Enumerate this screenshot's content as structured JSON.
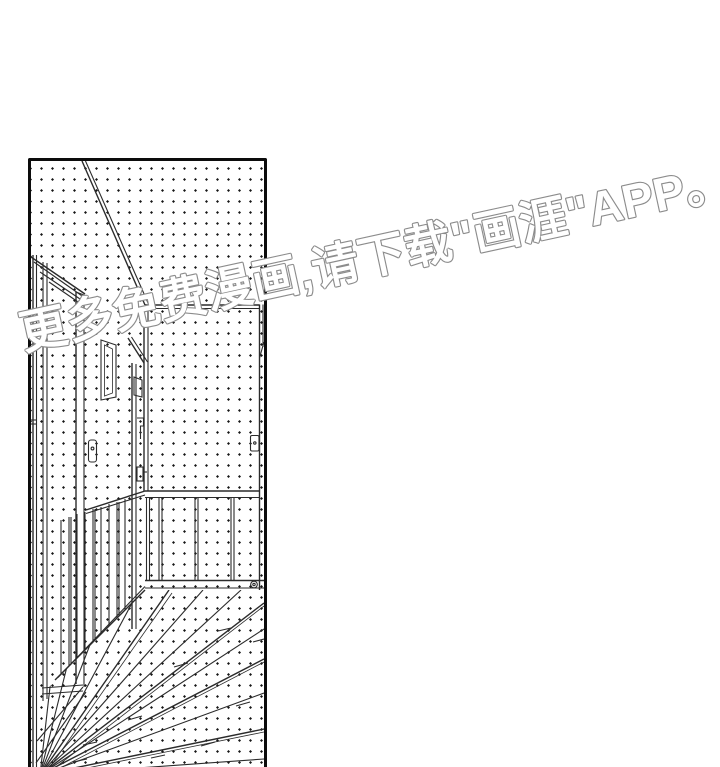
{
  "scene": {
    "type": "comic-page",
    "description": "Black-and-white manga panel: empty hallway interior with sliding doors, a light switch, wainscoting and a wood-plank floor, all covered in halftone dot screentone"
  },
  "watermark": {
    "text": "更多免费漫画,请下载\"画涯\"APP。",
    "fill_color": "#ffffff",
    "outline_color": "#8c8c8c"
  },
  "panel": {
    "border_color": "#0c0c0c",
    "ink_color": "#2b2b2b",
    "background_color": "#ffffff",
    "screentone": "halftone-dot-grid"
  }
}
